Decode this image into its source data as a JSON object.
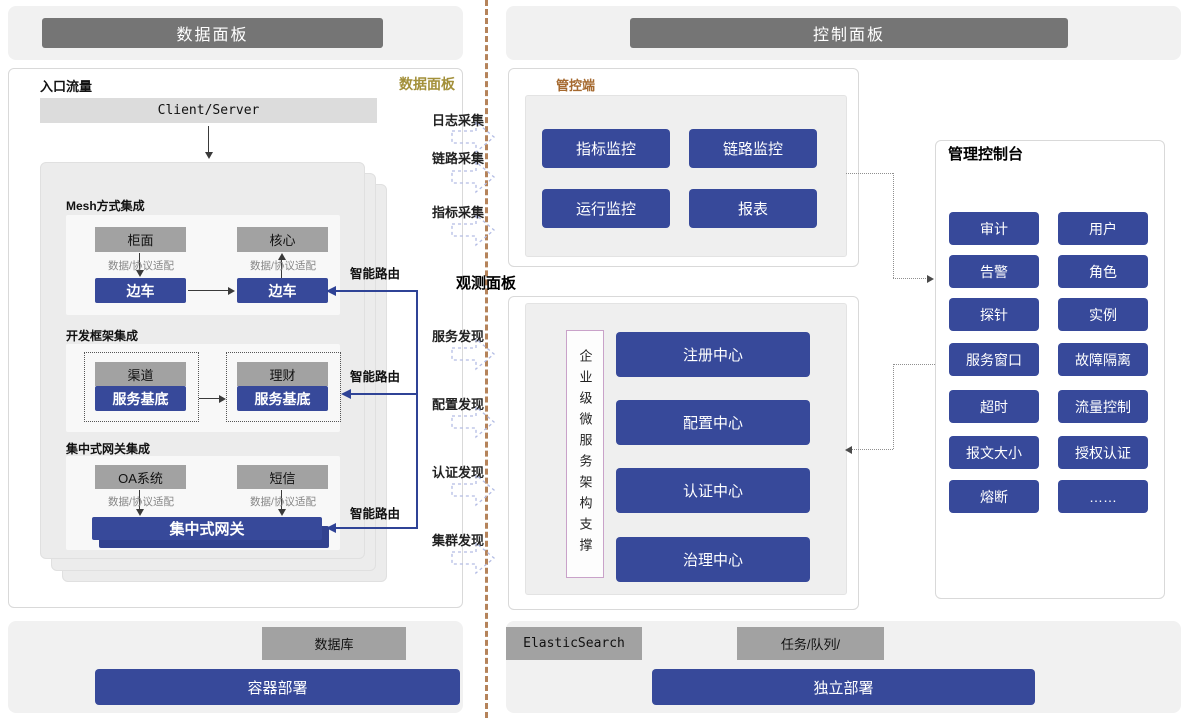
{
  "headers": {
    "data_panel": "数据面板",
    "control_panel": "控制面板"
  },
  "data_panel": {
    "entry_label": "入口流量",
    "corner_tag": "数据面板",
    "client_server": "Client/Server",
    "mesh": {
      "title": "Mesh方式集成",
      "left_top": "柜面",
      "right_top": "核心",
      "adapter": "数据/协议适配",
      "left_sidecar": "边车",
      "right_sidecar": "边车"
    },
    "framework": {
      "title": "开发框架集成",
      "left_top": "渠道",
      "right_top": "理财",
      "left_base": "服务基底",
      "right_base": "服务基底"
    },
    "gateway": {
      "title": "集中式网关集成",
      "left_top": "OA系统",
      "right_top": "短信",
      "adapter": "数据/协议适配",
      "bar": "集中式网关"
    },
    "smart_route": "智能路由"
  },
  "middle": {
    "collectors": [
      "日志采集",
      "链路采集",
      "指标采集"
    ],
    "observe_label": "观测面板",
    "discoveries": [
      "服务发现",
      "配置发现",
      "认证发现",
      "集群发现"
    ]
  },
  "control_plane": {
    "tag": "管控端",
    "buttons": [
      "指标监控",
      "链路监控",
      "运行监控",
      "报表"
    ]
  },
  "observe_panel": {
    "vertical_label": "企业级微服务架构支撑",
    "centers": [
      "注册中心",
      "配置中心",
      "认证中心",
      "治理中心"
    ]
  },
  "admin_console": {
    "title": "管理控制台",
    "buttons": [
      "审计",
      "用户",
      "告警",
      "角色",
      "探针",
      "实例",
      "服务窗口",
      "故障隔离",
      "超时",
      "流量控制",
      "报文大小",
      "授权认证",
      "熔断",
      "……"
    ]
  },
  "footer": {
    "database": "数据库",
    "container_deploy": "容器部署",
    "elasticsearch": "ElasticSearch",
    "task_queue": "任务/队列/",
    "standalone_deploy": "独立部署"
  },
  "colors": {
    "accent_blue": "#37499a",
    "header_gray": "#757575",
    "box_gray": "#a2a2a2",
    "tag_gold": "#a3903a",
    "tag_brown": "#a5692f",
    "divider_tan": "#b5835a"
  }
}
